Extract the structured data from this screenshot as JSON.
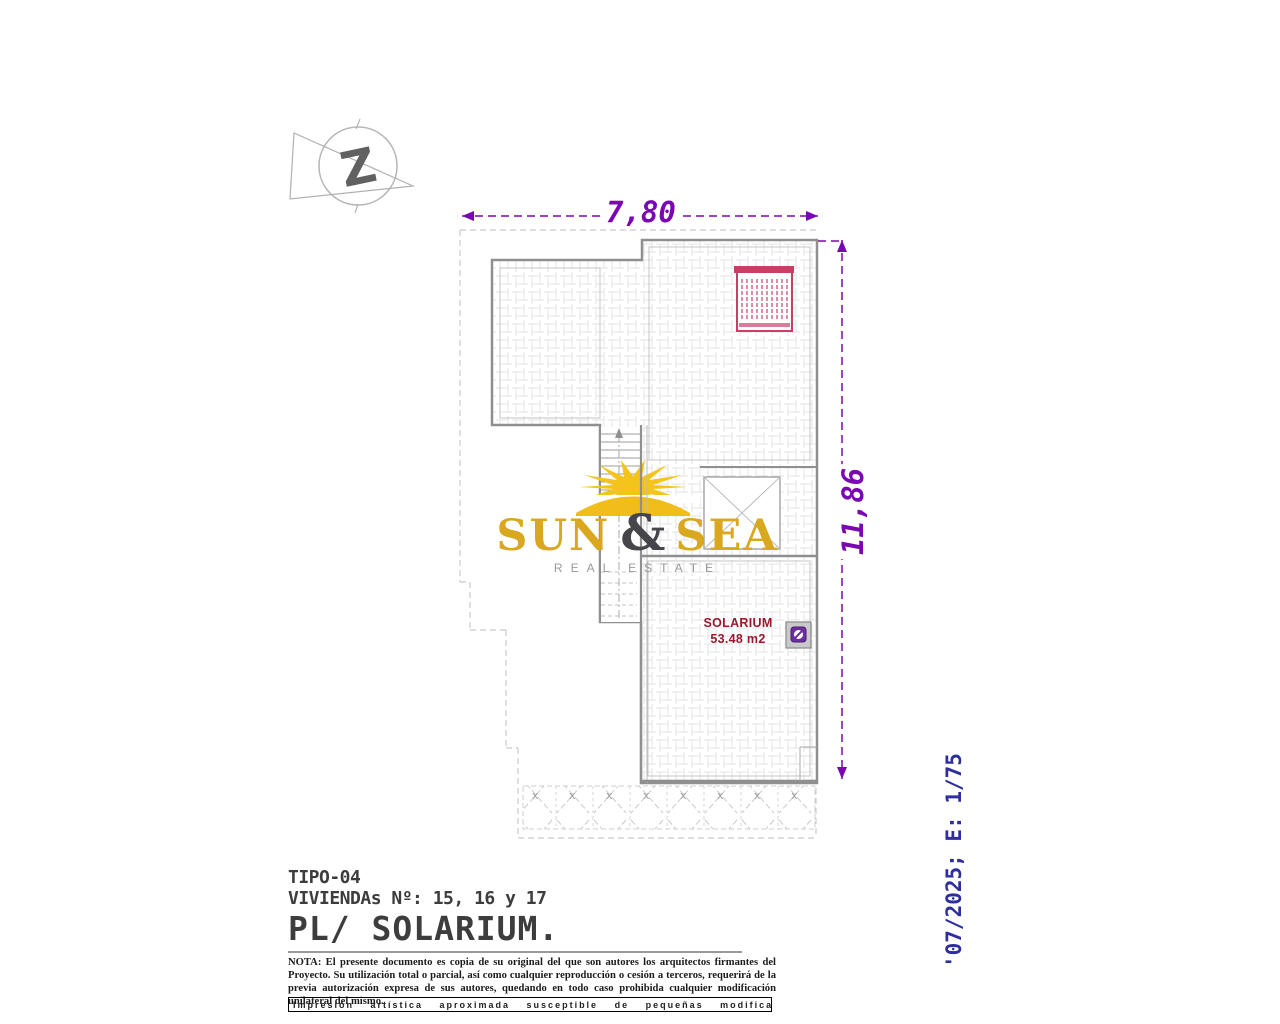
{
  "document": {
    "type_label": "TIPO-04",
    "units_label": "VIVIENDAs Nº: 15, 16 y 17",
    "plan_title": "PL/ SOLARIUM.",
    "note": "NOTA: El presente documento es copia de su original del que son autores los arquitectos firmantes del Proyecto. Su utilización total o parcial, así como cualquier reproducción o cesión a terceros, requerirá de la previa autorización expresa de sus autores, quedando en todo caso prohibida cualquier modificación unilateral del mismo.",
    "disclaimer": "Impresión artística aproximada susceptible de pequeñas modificaciones.",
    "date_scale": "'07/2025; E: 1/75"
  },
  "plan": {
    "width_dim": "7,80",
    "height_dim": "11,86",
    "room_name": "SOLARIUM",
    "room_area": "53.48 m2"
  },
  "logo": {
    "word1": "SUN",
    "amp": "&",
    "word2": "SEA",
    "subtitle": "REAL ESTATE"
  },
  "marks": {
    "north_glyph": "Z",
    "trellis_mark": "x"
  },
  "icons": {
    "north": "north-arrow-icon",
    "sun": "sun-logo-icon",
    "grill": "pergola-grill-icon",
    "fixture": "drain-symbol-icon"
  },
  "colors": {
    "dimension_purple": "#7a06b4",
    "wall_gray": "#8f8f8f",
    "guide_gray": "#cbcbcb",
    "grill_red": "#c64064",
    "room_label_red": "#9c1730",
    "fixture_purple": "#6b2fa0",
    "logo_gold": "#d9a81e",
    "sun_yellow": "#f4c41d",
    "logo_amp_gray": "#45454a",
    "scale_blue": "#2e2e9e"
  }
}
